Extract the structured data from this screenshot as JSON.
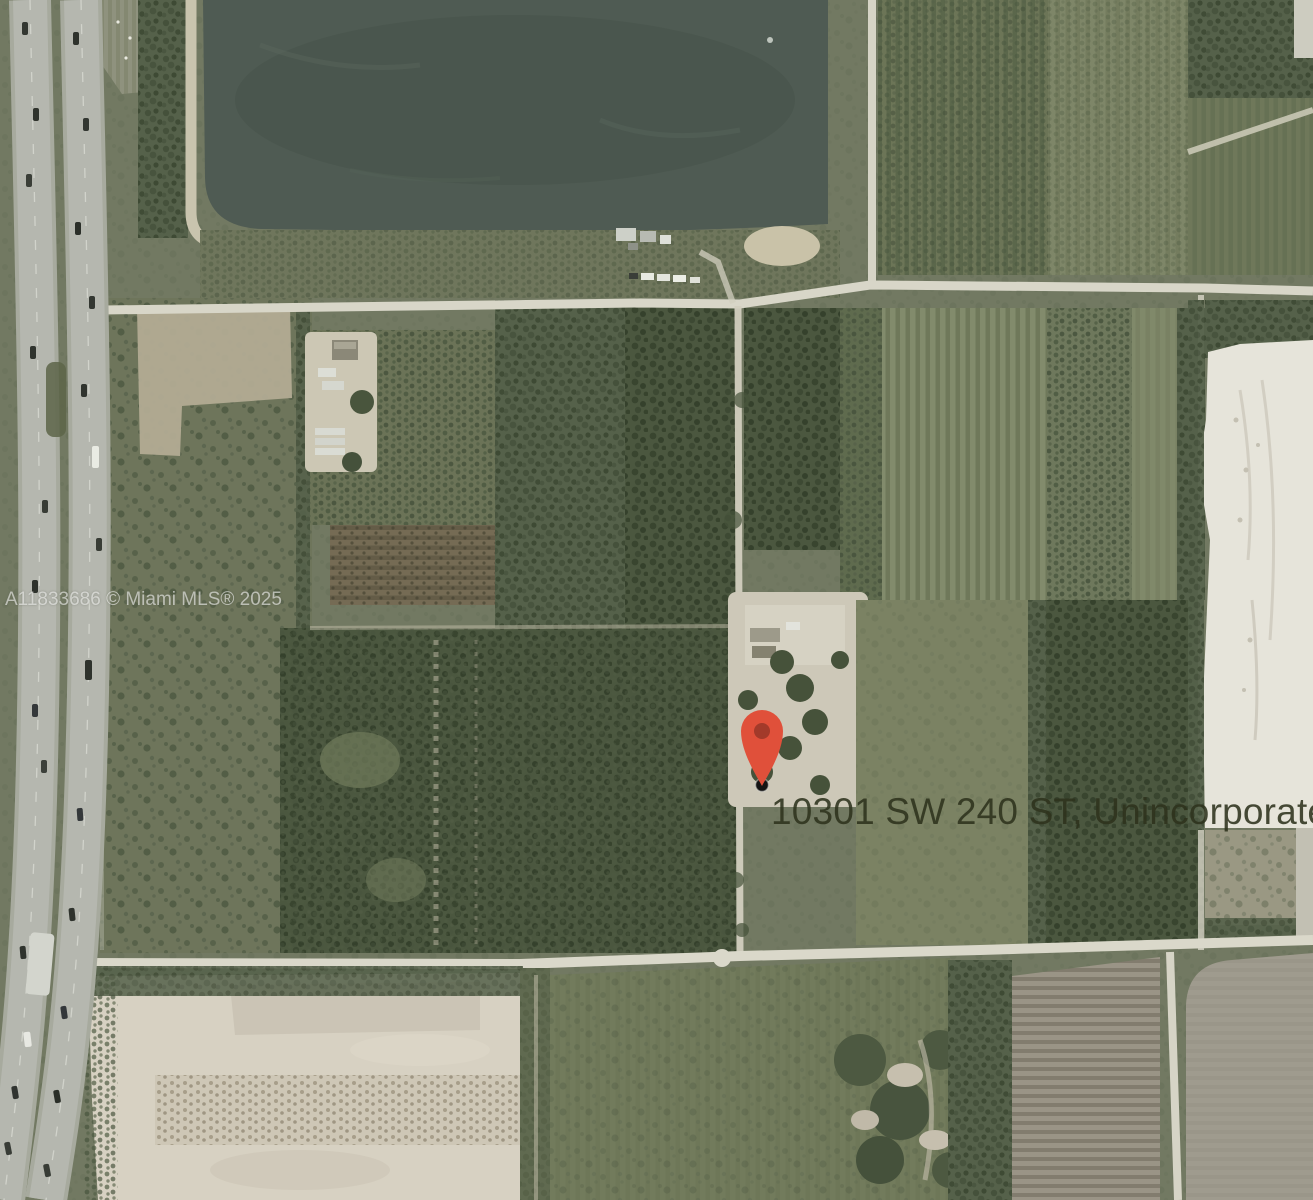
{
  "map": {
    "view": "satellite",
    "watermark_text": "A11833686 © Miami MLS® 2025",
    "address_label": "10301 SW 240 ST, Unincorporated Co",
    "pin": {
      "color": "#e0503a",
      "inner_color": "#a23a2a",
      "dot_color": "#141414"
    },
    "colors": {
      "water": "#4f5b53",
      "grass_base": "#727962",
      "woods": "#55614a",
      "dirt_road": "#d8d6c8",
      "highway_asphalt": "#b5b7af",
      "sand_lot": "#d7d1c2",
      "sand_pit": "#e6e4da",
      "plowed_gray": "#a19d90",
      "address_text": "rgba(45,50,28,0.88)",
      "watermark_text": "rgba(242,242,240,0.62)"
    }
  }
}
